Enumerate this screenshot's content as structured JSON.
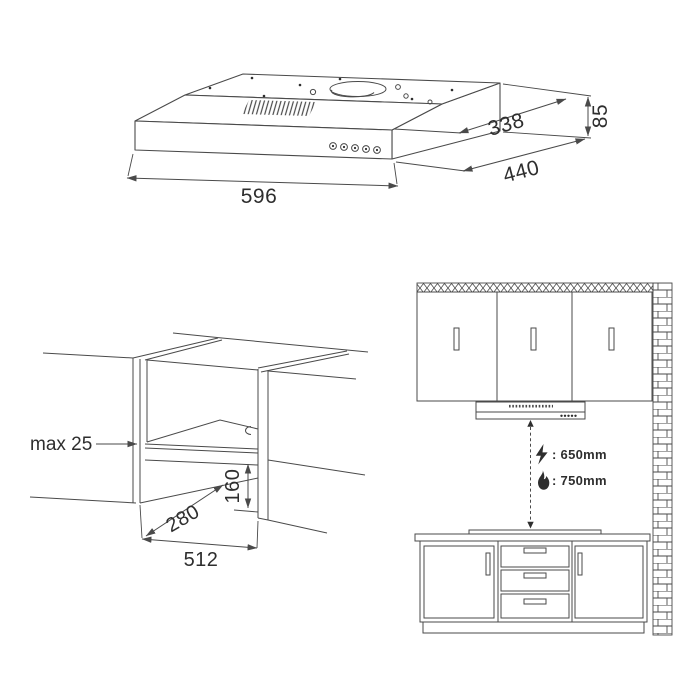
{
  "page": {
    "background": "#ffffff",
    "line_color": "#4a4a4a",
    "text_color": "#2e2e2e"
  },
  "hood_view": {
    "width_mm": "596",
    "depth_mm": "440",
    "top_depth_mm": "338",
    "rear_height_mm": "85"
  },
  "cutout_view": {
    "panel_thickness_label": "max 25",
    "recess_height_mm": "160",
    "recess_depth_mm": "280",
    "opening_width_mm": "512"
  },
  "installation_view": {
    "electric_hob_clearance": ": 650mm",
    "gas_hob_clearance": ": 750mm"
  }
}
